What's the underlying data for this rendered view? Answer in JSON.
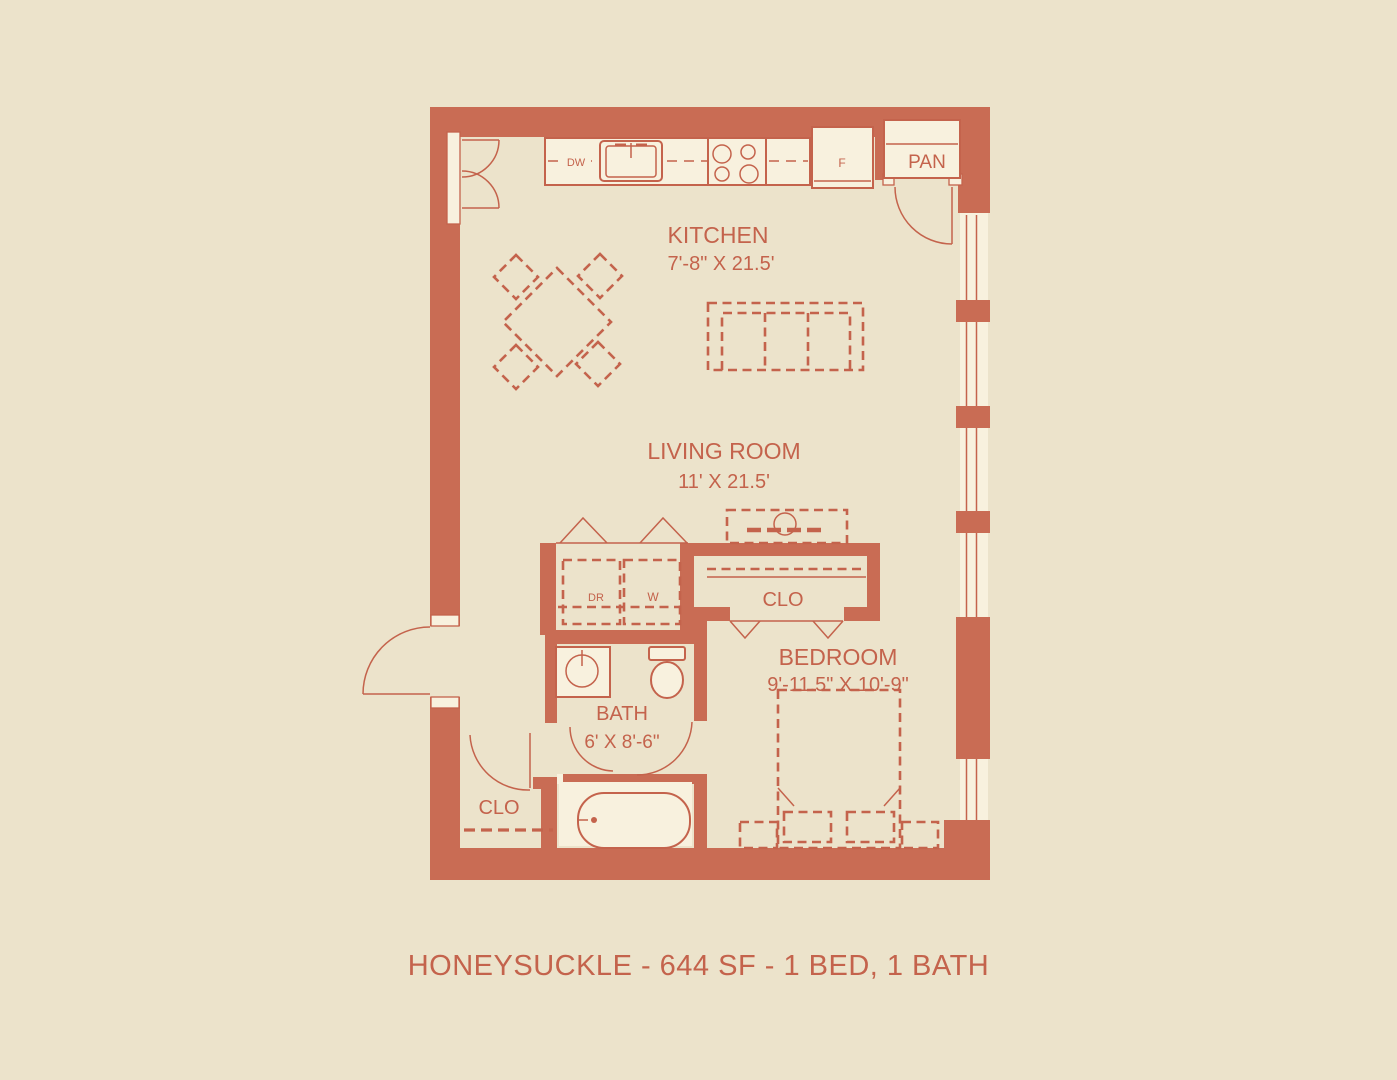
{
  "title": "HONEYSUCKLE - 644 SF - 1 BED, 1 BATH",
  "colors": {
    "wall": "#c96c54",
    "line": "#c4634c",
    "background": "#ece3cb",
    "fixture": "#f8f1de"
  },
  "rooms": {
    "kitchen": {
      "name": "KITCHEN",
      "dims": "7'-8\" X 21.5'"
    },
    "living_room": {
      "name": "LIVING ROOM",
      "dims": "11' X 21.5'"
    },
    "bedroom": {
      "name": "BEDROOM",
      "dims": "9'-11.5\" X 10'-9\""
    },
    "bath": {
      "name": "BATH",
      "dims": "6' X 8'-6\""
    },
    "bedroom_closet": {
      "name": "CLO"
    },
    "hall_closet": {
      "name": "CLO"
    },
    "pantry": {
      "name": "PAN"
    }
  },
  "appliances": {
    "dishwasher": "DW",
    "refrigerator": "F",
    "dryer": "DR",
    "washer": "W"
  }
}
